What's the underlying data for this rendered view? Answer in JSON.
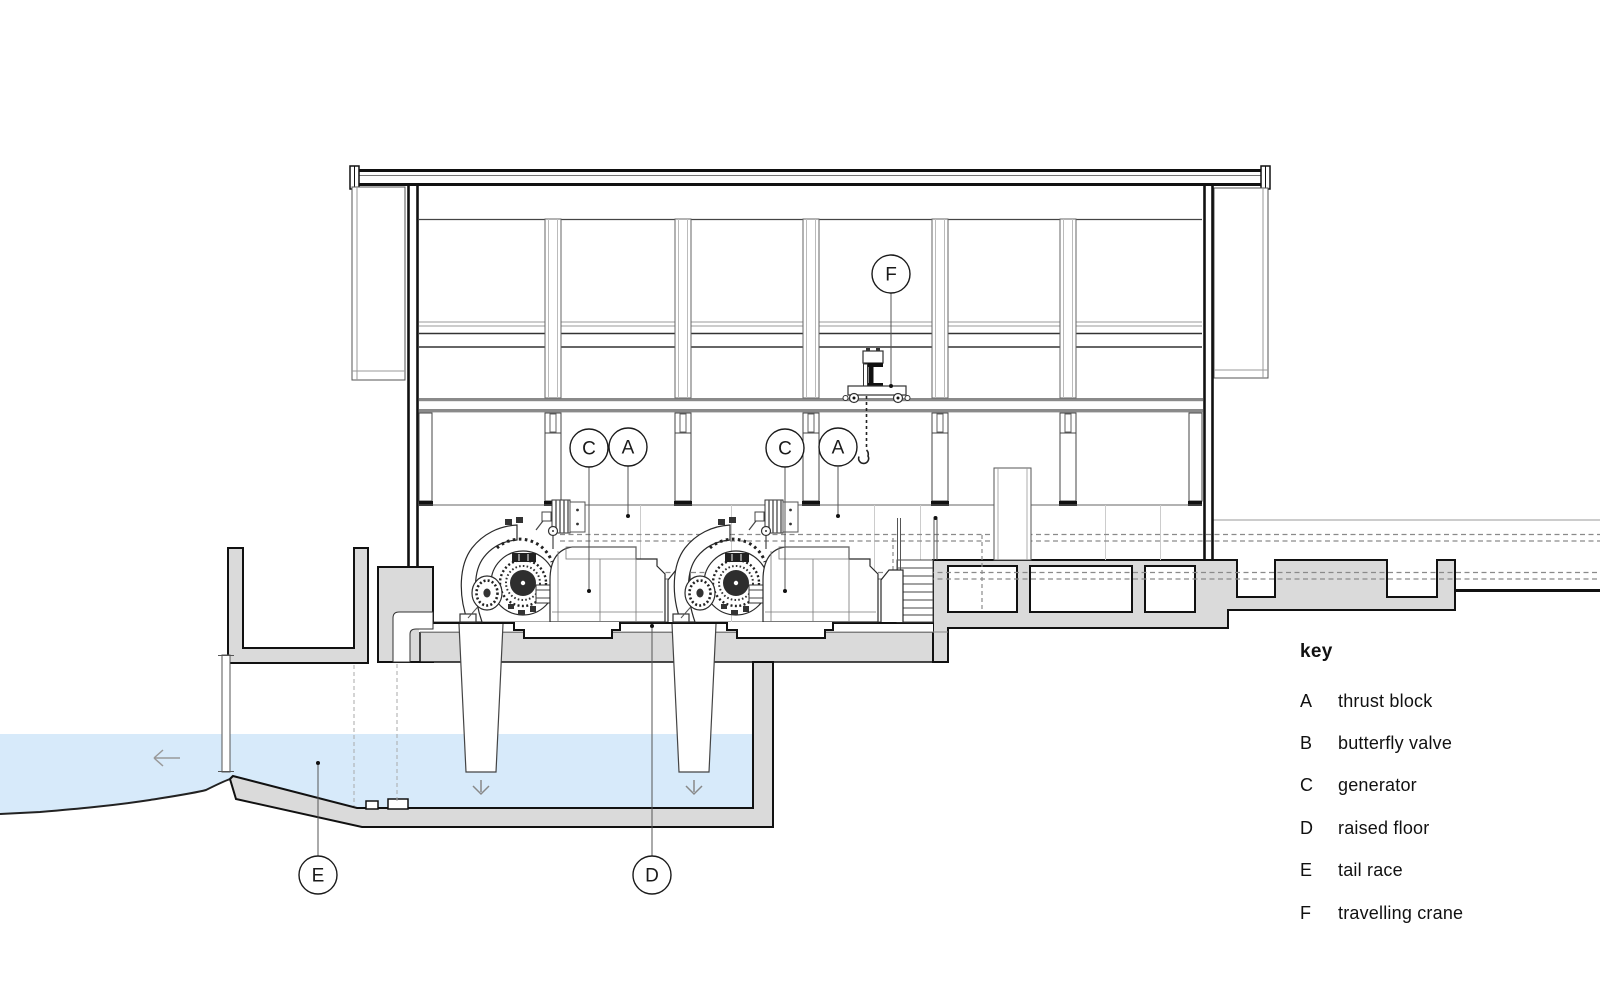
{
  "drawing_type": "section-drawing",
  "colors": {
    "water": "#d7eafa",
    "concrete": "#dadada",
    "line": "#1a1a1a"
  },
  "annotations": {
    "f": "F",
    "c1": "C",
    "a1": "A",
    "c2": "C",
    "a2": "A",
    "e": "E",
    "d": "D"
  },
  "key": {
    "title": "key",
    "entries": [
      {
        "letter": "A",
        "label": "thrust block"
      },
      {
        "letter": "B",
        "label": "butterfly valve"
      },
      {
        "letter": "C",
        "label": "generator"
      },
      {
        "letter": "D",
        "label": "raised floor"
      },
      {
        "letter": "E",
        "label": "tail race"
      },
      {
        "letter": "F",
        "label": "travelling crane"
      }
    ]
  }
}
